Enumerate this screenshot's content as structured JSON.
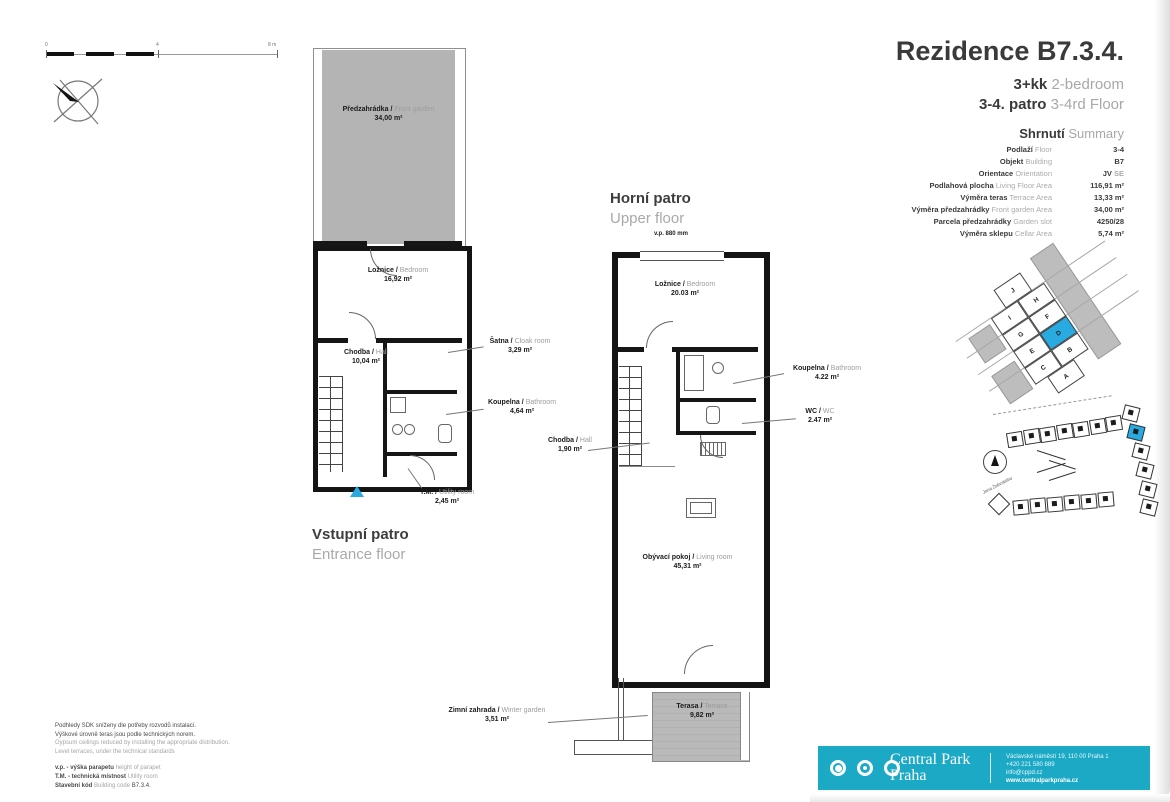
{
  "sep": "/",
  "header": {
    "title": "Rezidence B7.3.4.",
    "type_cz": "3+kk",
    "type_en": "2-bedroom",
    "floor_cz": "3-4. patro",
    "floor_en": "3-4rd Floor"
  },
  "summary": {
    "heading_cz": "Shrnutí",
    "heading_en": "Summary",
    "rows": [
      {
        "cz": "Podlaží",
        "en": "Floor",
        "value": "3-4",
        "value2": ""
      },
      {
        "cz": "Objekt",
        "en": "Building",
        "value": "B7",
        "value2": ""
      },
      {
        "cz": "Orientace",
        "en": "Orientation",
        "value": "JV",
        "value2": " SE"
      },
      {
        "cz": "Podlahová plocha",
        "en": "Living Floor Area",
        "value": "116,91 m²",
        "value2": ""
      },
      {
        "cz": "Výměra teras",
        "en": "Terrace Area",
        "value": "13,33 m²",
        "value2": ""
      },
      {
        "cz": "Výměra předzahrádky",
        "en": "Front garden Area",
        "value": "34,00 m²",
        "value2": ""
      },
      {
        "cz": "Parcela předzahrádky",
        "en": "Garden slot",
        "value": "4250/28",
        "value2": ""
      },
      {
        "cz": "Výměra sklepu",
        "en": "Cellar Area",
        "value": "5,74 m²",
        "value2": ""
      }
    ]
  },
  "entrance": {
    "title_cz": "Vstupní patro",
    "title_en": "Entrance floor",
    "garden": {
      "cz": "Předzahrádka",
      "en": "Front garden",
      "area": "34,00 m²"
    },
    "bedroom": {
      "cz": "Ložnice",
      "en": "Bedroom",
      "area": "16,92 m²"
    },
    "hall": {
      "cz": "Chodba",
      "en": "Hall",
      "area": "10,04 m²"
    },
    "cloak": {
      "cz": "Šatna",
      "en": "Cloak room",
      "area": "3,29 m²"
    },
    "bath": {
      "cz": "Koupelna",
      "en": "Bathroom",
      "area": "4,64 m²"
    },
    "utility": {
      "cz": "T.M.",
      "en": "Utility room",
      "area": "2,45 m²"
    }
  },
  "upper": {
    "title_cz": "Horní patro",
    "title_en": "Upper floor",
    "parapet": "v.p. 880 mm",
    "bedroom": {
      "cz": "Ložnice",
      "en": "Bedroom",
      "area": "20.03 m²"
    },
    "bath": {
      "cz": "Koupelna",
      "en": "Bathroom",
      "area": "4.22 m²"
    },
    "wc": {
      "cz": "WC",
      "en": "WC",
      "area": "2.47 m²"
    },
    "hall": {
      "cz": "Chodba",
      "en": "Hall",
      "area": "1,90 m²"
    },
    "living": {
      "cz": "Obývací pokoj",
      "en": "Living room",
      "area": "45,31 m²"
    },
    "winter": {
      "cz": "Zimní zahrada",
      "en": "Winter garden",
      "area": "3,51 m²"
    },
    "terrace": {
      "cz": "Terasa",
      "en": "Terrace",
      "area": "9,82 m²"
    }
  },
  "scale": {
    "t0": "0",
    "t1": "4",
    "t2": "8 m"
  },
  "plot": {
    "cells": [
      "J",
      "I",
      "H",
      "G",
      "F",
      "E",
      "D",
      "C",
      "B",
      "A"
    ],
    "highlight": "D"
  },
  "sitemap": {
    "street1": "Pitterova ulice",
    "street2": "Jana Želivského"
  },
  "notes": {
    "cz1": "Podhledy SDK sníženy dle potřeby rozvodů instalací.",
    "cz2": "Výškové úrovně teras jsou podle technických norem.",
    "en1": "Gypsum ceilings reduced by installing the appropriate distribution.",
    "en2": "Level terraces, under the technical standards",
    "leg1_cz": "v.p. - výška parapetu",
    "leg1_en": "height of parapet",
    "leg2_cz": "T.M. - technická místnost",
    "leg2_en": "Utility room",
    "leg3_cz": "Stavební kód",
    "leg3_en": "Building code",
    "leg3_val": "B7.3.4."
  },
  "footer": {
    "brand1": "Central Park",
    "brand2": "Praha",
    "address": "Václavské náměstí 19, 110 00 Praha 1",
    "phone": "+420 221 580 889",
    "email": "info@cppd.cz",
    "web": "www.centralparkpraha.cz",
    "accent": "#1BA9C6",
    "highlight": "#29ABE2"
  }
}
